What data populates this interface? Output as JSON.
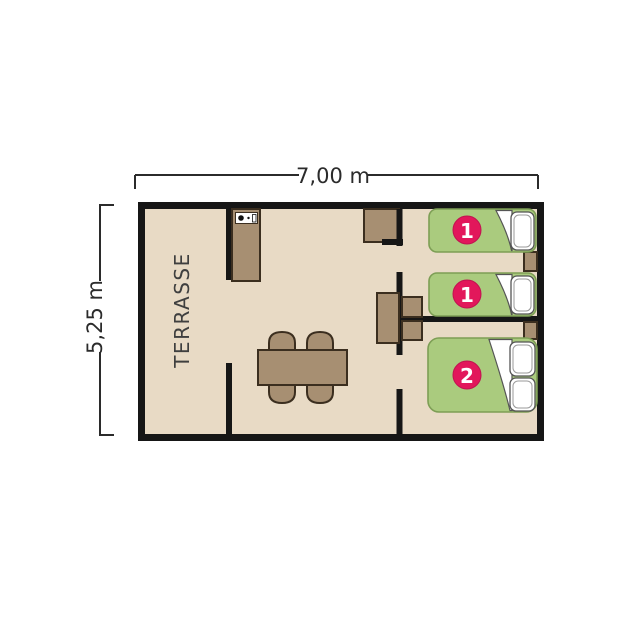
{
  "diagram": {
    "type": "floor-plan",
    "description": "Mobile-home / bungalow floor plan with terrace, living-kitchen area and two bedrooms"
  },
  "dimensions": {
    "width_label": "7,00 m",
    "height_label": "5,25 m"
  },
  "terrace": {
    "label": "TERRASSE"
  },
  "beds": [
    {
      "badge": "1",
      "type": "single-bed"
    },
    {
      "badge": "1",
      "type": "single-bed"
    },
    {
      "badge": "2",
      "type": "double-bed"
    }
  ],
  "colors": {
    "background": "#FFFFFF",
    "floor": "#E8DAC5",
    "wall": "#161616",
    "furniture": "#A78F72",
    "furniture_outline": "#3B2E1F",
    "bed_fill": "#AACB7E",
    "bed_outline": "#7D9E55",
    "badge": "#E2175B",
    "pillow": "#FFFFFF",
    "dimension_text": "#2B2B2B"
  }
}
